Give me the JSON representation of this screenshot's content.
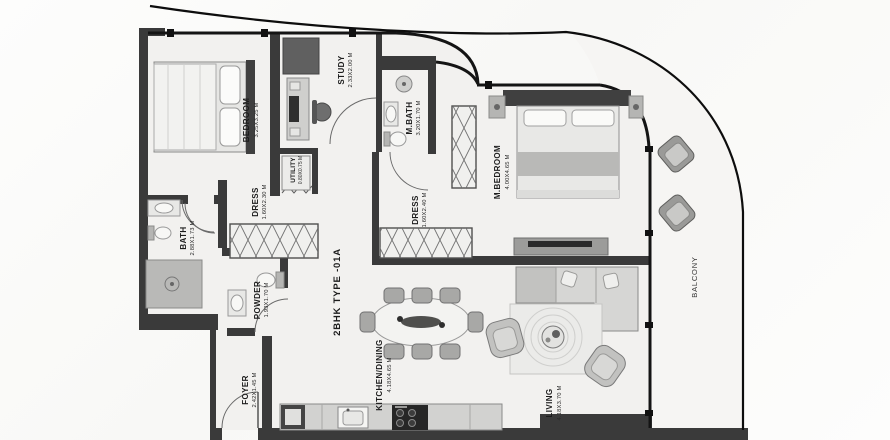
{
  "plan": {
    "title": "2BHK TYPE -01A",
    "rooms": {
      "bedroom": {
        "name": "BEDROOM",
        "dims": "3.25X3.25 M"
      },
      "study": {
        "name": "STUDY",
        "dims": "2.33X2.00 M"
      },
      "utility": {
        "name": "UTILITY",
        "dims": "0.80X0.75 M"
      },
      "mbath": {
        "name": "M.BATH",
        "dims": "3.20X1.70 M"
      },
      "dress_a": {
        "name": "DRESS",
        "dims": "1.60X2.30 M"
      },
      "dress_b": {
        "name": "DRESS",
        "dims": "1.60X2.40 M"
      },
      "mbedroom": {
        "name": "M.BEDROOM",
        "dims": "4.00X4.65 M"
      },
      "bath": {
        "name": "BATH",
        "dims": "2.88X1.73 M"
      },
      "powder": {
        "name": "POWDER",
        "dims": "1.93X1.70 M"
      },
      "foyer": {
        "name": "FOYER",
        "dims": "2.42X1.45 M"
      },
      "kitchen_dining": {
        "name": "KITCHEN/DINING",
        "dims": "4.18X4.65 M"
      },
      "living": {
        "name": "LIVING",
        "dims": "4.18X3.70 M"
      },
      "balcony": {
        "name": "BALCONY",
        "dims": ""
      }
    },
    "colors": {
      "wall": "#3a3a3a",
      "line": "#141414",
      "floor": "#f2f1ef",
      "balcony_floor": "#f6f5f3",
      "label": "#1c1c1c"
    }
  }
}
